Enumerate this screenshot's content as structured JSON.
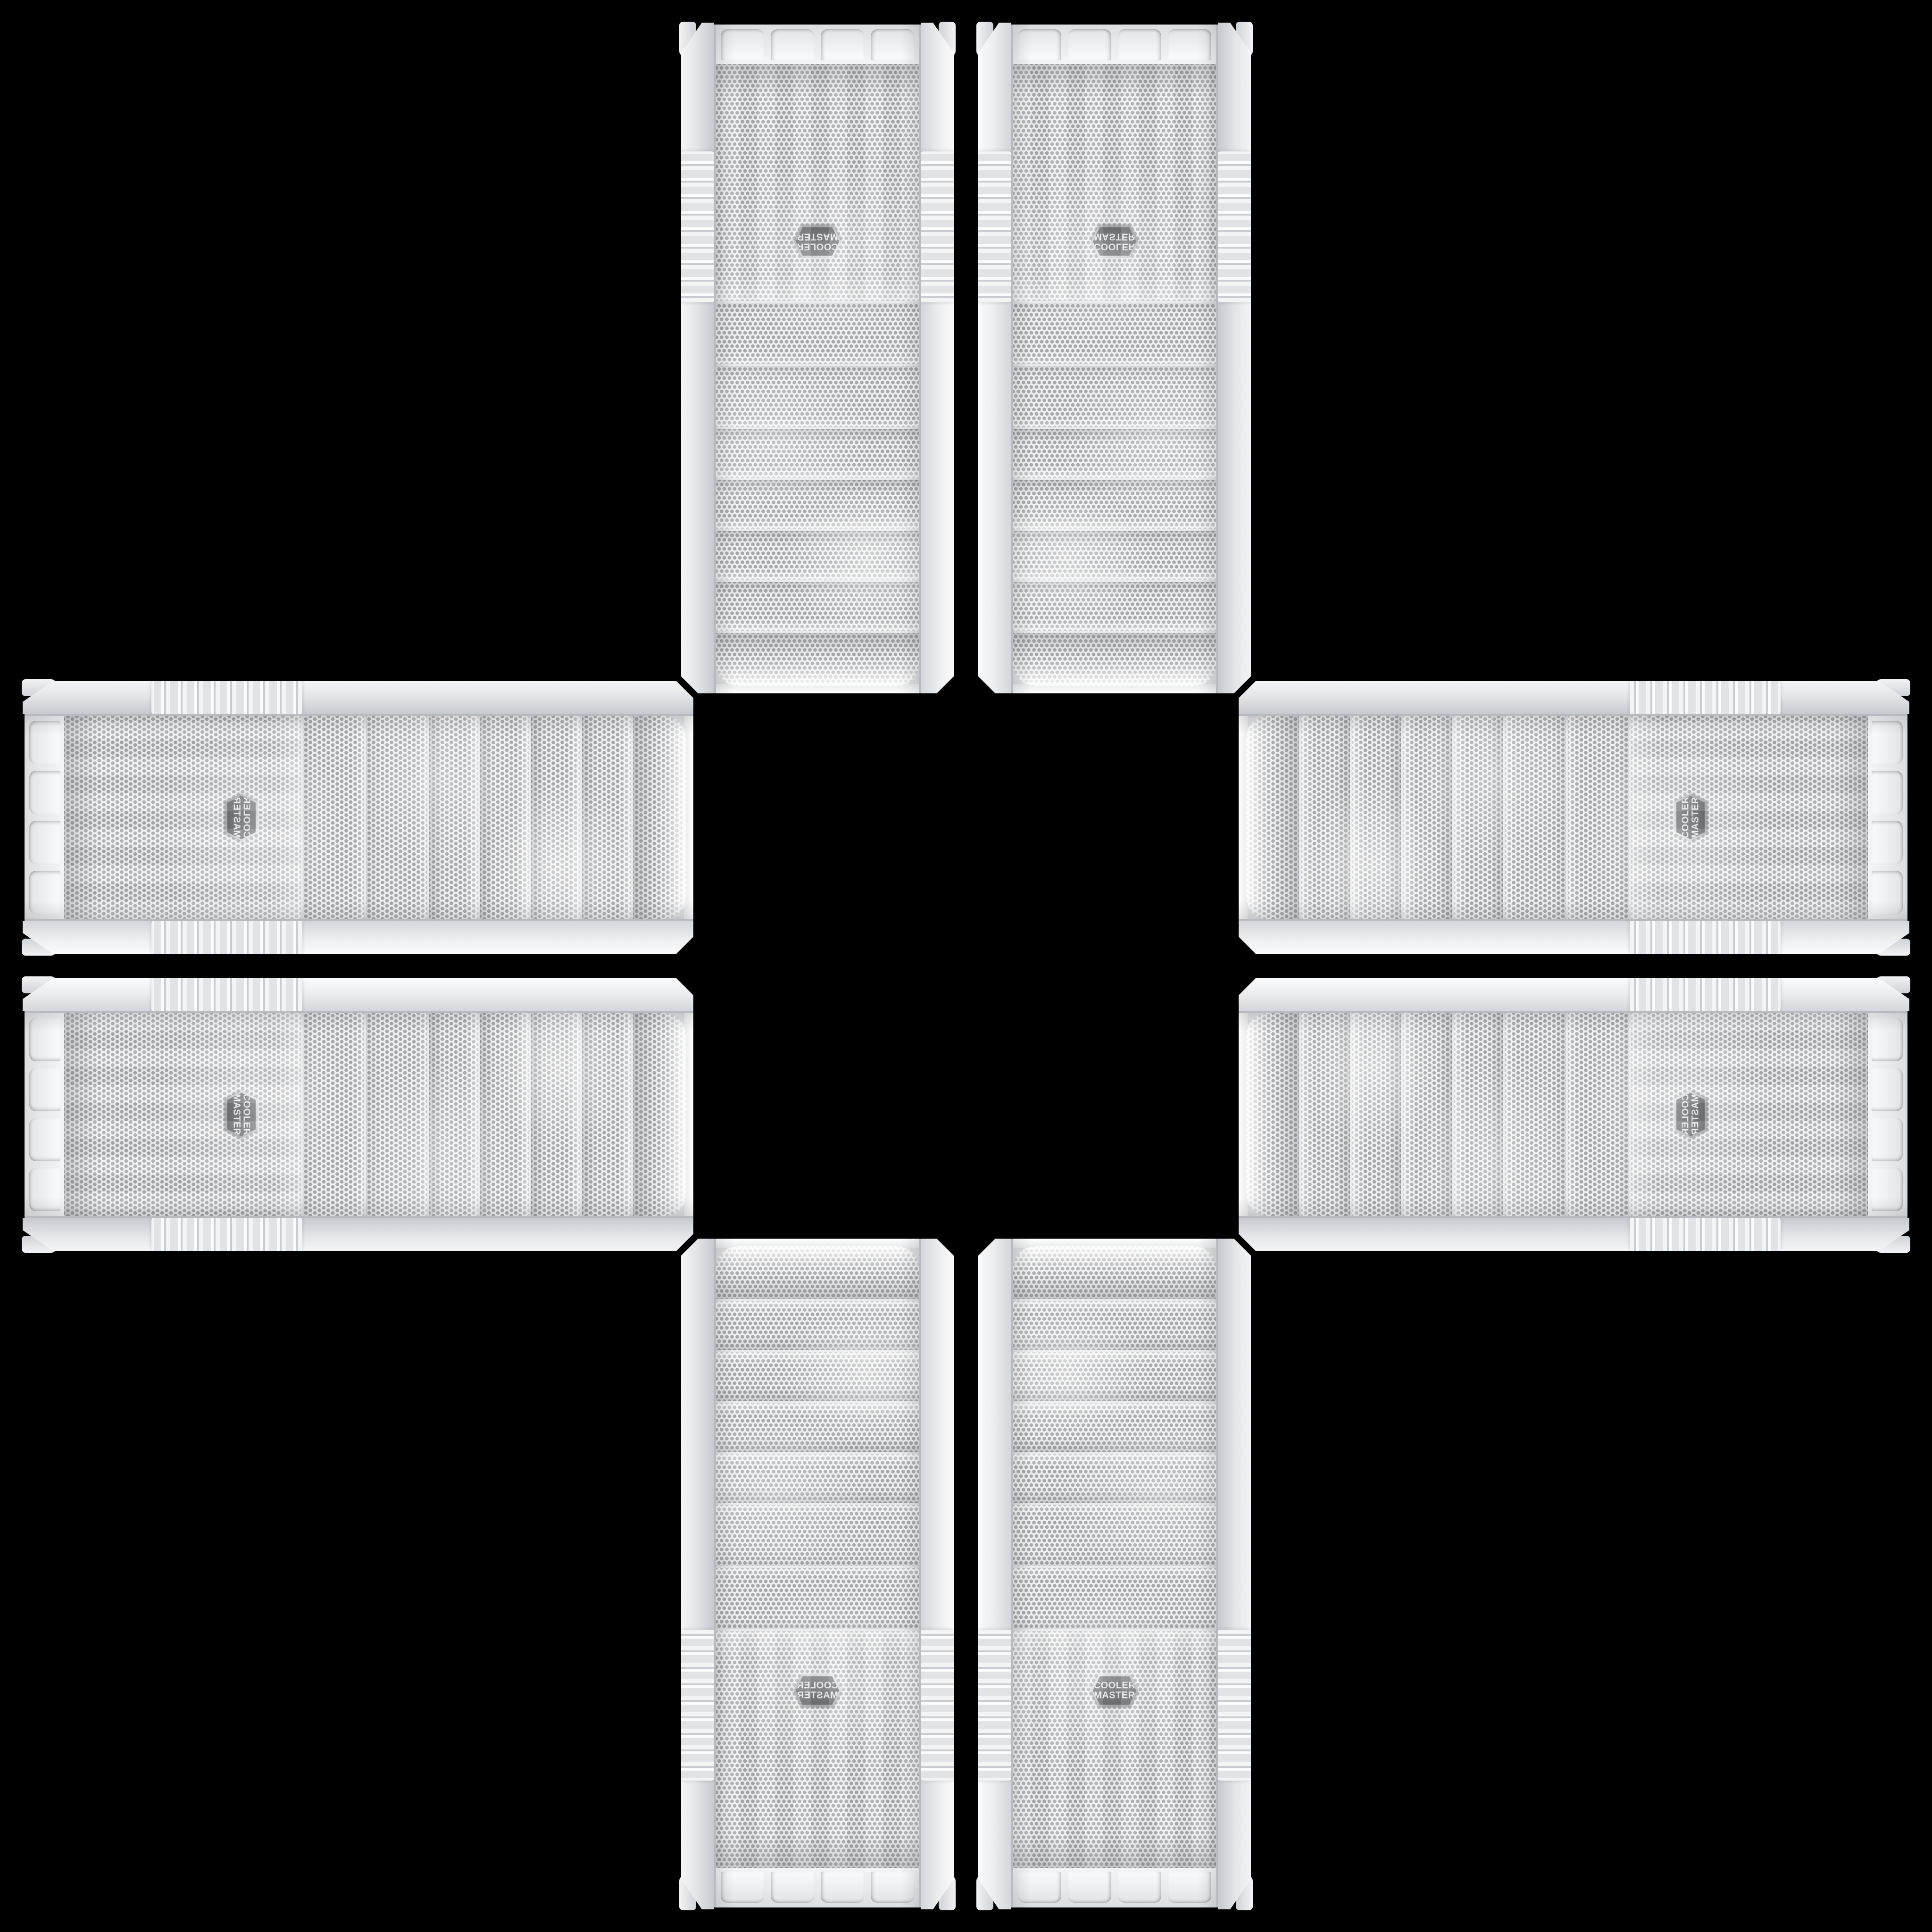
{
  "scene": {
    "type": "product-photo-collage",
    "background_color": "#000000",
    "description": "Eight identical white Cooler Master mesh-front PC tower front panels arranged in a mirrored cross / plus pattern on a black background; the center of the cross is empty.",
    "symmetry": "4-fold mirror symmetry; every copy is a rotation or mirror of the same case photo with its top cap facing the image center"
  },
  "case": {
    "brand": "Cooler Master",
    "finish": "white plastic with perforated metal mesh",
    "panel": {
      "drive_bay_covers": 4,
      "lower_mesh_covers": 2,
      "fan_grille_panels": 1,
      "bottom_cap_tabs": 4,
      "side_grip_ribs": true
    },
    "colors": {
      "plastic_light": "#fafbfc",
      "plastic_mid": "#e4e6e9",
      "plastic_shadow": "#c9ccd1",
      "mesh_background": "#eff0f1",
      "mesh_dot": "#a7a8aa",
      "chrome_trim": "#b7babf",
      "badge_face": "#46484b",
      "badge_rim": "#c6c8cb",
      "badge_text": "#e2e3e5"
    }
  },
  "badge": {
    "line1": "COOLER",
    "line2": "MASTER"
  },
  "instances": [
    {
      "name": "tower-top-left",
      "orientation": "upside-down, mirrored"
    },
    {
      "name": "tower-top-right",
      "orientation": "upside-down"
    },
    {
      "name": "case-left-top",
      "orientation": "rotated 90deg, mirrored, logo reversed"
    },
    {
      "name": "case-right-top",
      "orientation": "rotated 90deg CCW, logo reads bottom-to-top"
    },
    {
      "name": "case-left-bottom",
      "orientation": "rotated 90deg, mirrored both axes"
    },
    {
      "name": "case-right-bottom",
      "orientation": "rotated 90deg CCW, flipped vertically"
    },
    {
      "name": "tower-bottom-left",
      "orientation": "upright, mirrored"
    },
    {
      "name": "tower-bottom-right",
      "orientation": "upright, logo readable"
    }
  ]
}
